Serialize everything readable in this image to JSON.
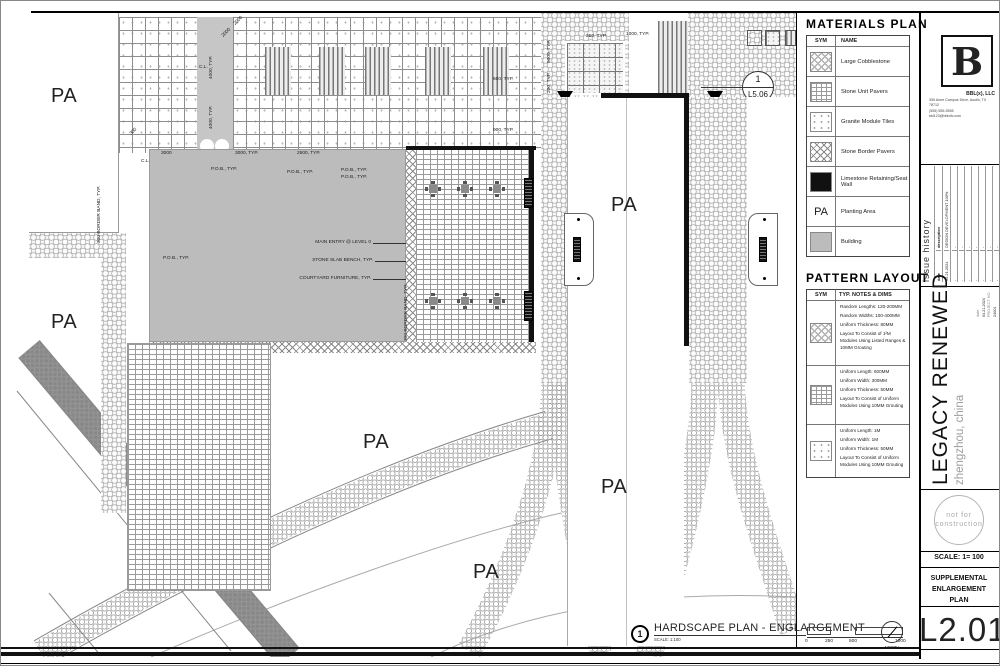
{
  "colors": {
    "building": "#bcbcbc",
    "wall": "#111111",
    "paper": "#ffffff",
    "muted_gray": "#9a9a9a"
  },
  "firm": {
    "logo": "B",
    "name": "BBL(x), LLC",
    "address": "355 Anne Campus Drive, Austin, TX 78712",
    "phone": "(555) 555-5555",
    "email": "bbl123@bblxllc.com"
  },
  "project": {
    "name": "LEGACY RENEWED",
    "location": "zhengzhou, china",
    "date_label": "date",
    "date": "04.21.2024",
    "number_label": "PROJECT NO.",
    "number": "24001"
  },
  "issue_history": {
    "title": "issue history",
    "date_col": "date",
    "desc_col": "description",
    "entry_date": "04.21.2024",
    "entry_desc": "DESIGN DEVELOPMENT 100%",
    "empty": "-"
  },
  "sheet": {
    "number": "L2.01",
    "title": "SUPPLEMENTAL ENLARGEMENT PLAN",
    "scale": "SCALE: 1= 100",
    "stamp_line1": "not for",
    "stamp_line2": "construction"
  },
  "materials": {
    "title": "MATERIALS PLAN",
    "sym_col": "SYM",
    "name_col": "NAME",
    "pa_sym": "PA",
    "rows": [
      {
        "name": "Large Cobblestone"
      },
      {
        "name": "Stone Unit Pavers"
      },
      {
        "name": "Granite Module Tiles"
      },
      {
        "name": "Stone Border Pavers"
      },
      {
        "name": "Limestone Retaining/Seat Wall"
      },
      {
        "name": "Planting Area"
      },
      {
        "name": "Building"
      }
    ]
  },
  "patterns": {
    "title": "PATTERN LAYOUT",
    "sym_col": "SYM",
    "notes_col": "TYP. NOTES & DIMS",
    "rows": [
      {
        "lines": [
          "Random Lengths: 120-200MM",
          "Random Widths: 100-400MM",
          "Uniform Thickness: 80MM",
          "Layout To Consist of 1²M  Modules Using Listed Ranges & 10MM Grouting"
        ]
      },
      {
        "lines": [
          "Uniform Length: 600MM",
          "Uniform Width: 300MM",
          "Uniform Thickness: 50MM",
          "Layout To Consist of Uniform Modules Using 10MM Grouting"
        ]
      },
      {
        "lines": [
          "Uniform Length: 1M",
          "Uniform Width: 1M",
          "Uniform Thickness: 50MM",
          "Layout To Consist of Uniform Modules Using 10MM Grouting"
        ]
      }
    ]
  },
  "titlebar": {
    "num": "1",
    "title": "HARDSCAPE PLAN - ENGLARGEMENT",
    "scale": "SCALE: 1:100",
    "t0": "0",
    "t1": "250",
    "t2": "500",
    "t3": "1000",
    "north": "NORTH"
  },
  "callout": {
    "num": "1",
    "sheet": "L5.06"
  },
  "labels": {
    "pa": "PA",
    "cl": "C.L.",
    "pob": "P.O.B., TYP.",
    "main_entry": "MAIN ENTRY @ LEVEL 0",
    "bench": "STONE SLAB BENCH, TYP.",
    "furniture": "COURTYARD FURNITURE, TYP.",
    "border_band": "300 BORDER BAND, TYP."
  },
  "dims": {
    "d300": "300",
    "d3000": "3000",
    "d3000t": "3000, TYP.",
    "d2500t": "2500, TYP.",
    "d2000": "2000",
    "d4000t": "4000, TYP.",
    "d250t": "250, TYP.",
    "d1000t": "1000, TYP.",
    "d5000t": "5000, TYP.",
    "d200t": "200, TYP.",
    "d5600t": "5600, TYP.",
    "d6000t": "6000, TYP.",
    "d600t": "600, TYP.",
    "d900t": "900, TYP."
  }
}
